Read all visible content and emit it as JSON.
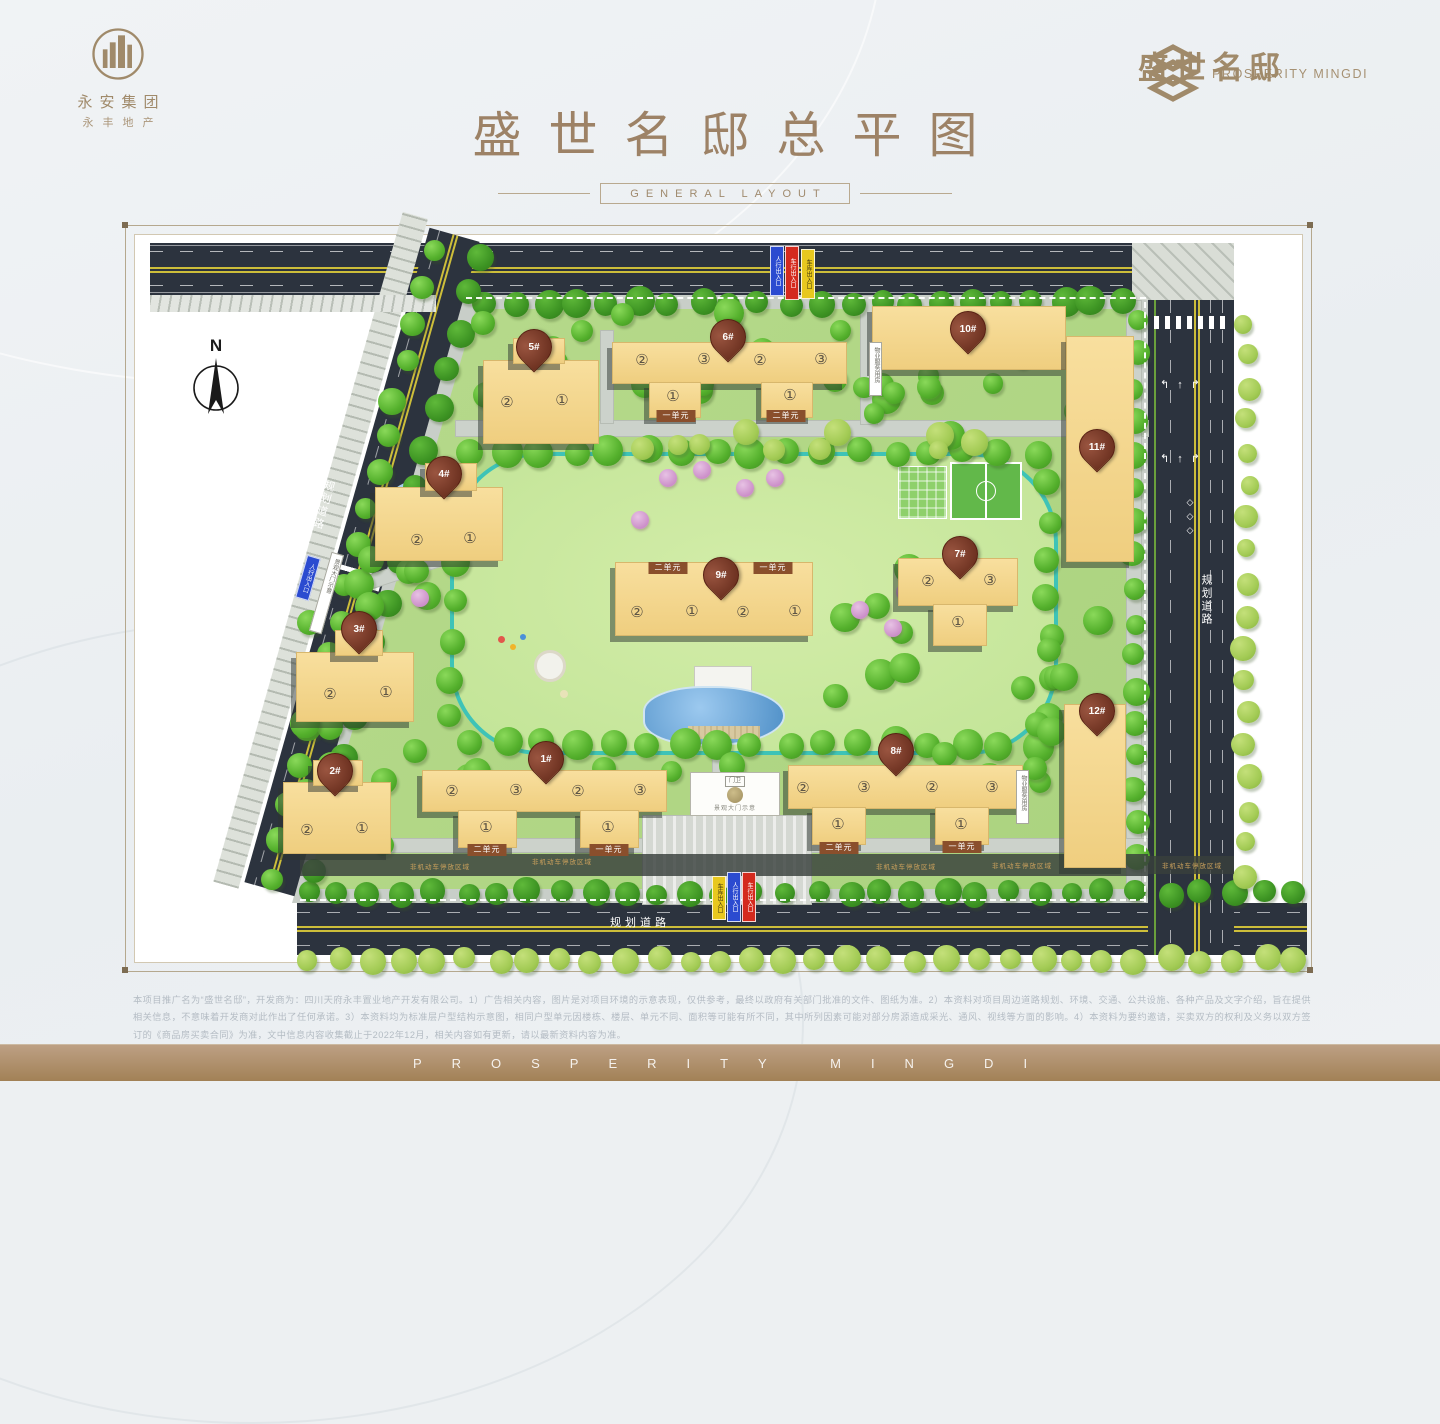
{
  "header": {
    "left_logo": {
      "line1": "永安集团",
      "line2": "永丰地产"
    },
    "title": "盛世名邸总平图",
    "subtitle": "GENERAL LAYOUT",
    "right_logo": {
      "cn": "盛世名邸",
      "en": "PROSPERITY MINGDI"
    }
  },
  "map": {
    "north_label": "N",
    "road_labels": [
      {
        "text": "规划道路",
        "x": 640,
        "y": 922,
        "mode": "h"
      },
      {
        "text": "规划道路",
        "x": 1206,
        "y": 600,
        "mode": "v"
      },
      {
        "text": "规划道路",
        "x": 323,
        "y": 505,
        "mode": "v",
        "rotate": 16
      }
    ],
    "entrance_flags": [
      {
        "text": "人行出入口",
        "color": "#2b4bd0",
        "x": 770,
        "y": 246,
        "h": 42
      },
      {
        "text": "车行出入口",
        "color": "#d42a1e",
        "x": 785,
        "y": 246,
        "h": 46
      },
      {
        "text": "车库出入口",
        "color": "#e8c81e",
        "x": 801,
        "y": 249,
        "h": 42,
        "dark": true
      },
      {
        "text": "车库出入口",
        "color": "#e8c81e",
        "x": 712,
        "y": 876,
        "h": 36,
        "dark": true
      },
      {
        "text": "人行出入口",
        "color": "#2b4bd0",
        "x": 727,
        "y": 872,
        "h": 42
      },
      {
        "text": "车行出入口",
        "color": "#d42a1e",
        "x": 742,
        "y": 872,
        "h": 42
      },
      {
        "text": "人行出入口",
        "color": "#2b4bd0",
        "x": 301,
        "y": 556,
        "h": 36,
        "rotate": 16
      }
    ],
    "signs": [
      {
        "text": "景观大门示意",
        "x": 320,
        "y": 552,
        "h": 80,
        "rotate": 16
      },
      {
        "text": "物业服务用房",
        "x": 869,
        "y": 342,
        "h": 52
      },
      {
        "text": "物业服务用房",
        "x": 1016,
        "y": 770,
        "h": 52
      }
    ],
    "gate_sign": {
      "text": "景观大门示意",
      "guard": "门卫",
      "x": 690,
      "y": 772,
      "w": 88,
      "h": 42
    },
    "parking_label": "非机动车停放区域",
    "parking_positions": [
      [
        440,
        866
      ],
      [
        562,
        861
      ],
      [
        906,
        866
      ],
      [
        1022,
        865
      ],
      [
        1192,
        865
      ]
    ],
    "buildings": [
      {
        "id": "1#",
        "pin": [
          545,
          782
        ],
        "rects": [
          [
            422,
            770,
            243,
            40
          ],
          [
            458,
            810,
            57,
            36
          ],
          [
            580,
            810,
            57,
            36
          ]
        ],
        "labels": [
          [
            "②",
            452,
            791
          ],
          [
            "③",
            516,
            790
          ],
          [
            "②",
            578,
            791
          ],
          [
            "③",
            640,
            790
          ],
          [
            "①",
            486,
            827
          ],
          [
            "①",
            608,
            827
          ]
        ],
        "banners": [
          [
            "二单元",
            487,
            850
          ],
          [
            "一单元",
            609,
            850
          ]
        ]
      },
      {
        "id": "2#",
        "pin": [
          334,
          794
        ],
        "rects": [
          [
            283,
            782,
            106,
            70
          ],
          [
            313,
            760,
            48,
            24
          ]
        ],
        "labels": [
          [
            "②",
            307,
            830
          ],
          [
            "①",
            362,
            828
          ]
        ],
        "banners": []
      },
      {
        "id": "3#",
        "pin": [
          358,
          652
        ],
        "rects": [
          [
            296,
            652,
            116,
            68
          ],
          [
            335,
            630,
            46,
            24
          ]
        ],
        "labels": [
          [
            "②",
            330,
            694
          ],
          [
            "①",
            386,
            692
          ]
        ],
        "banners": []
      },
      {
        "id": "4#",
        "pin": [
          443,
          497
        ],
        "rects": [
          [
            375,
            487,
            126,
            72
          ],
          [
            425,
            463,
            50,
            26
          ]
        ],
        "labels": [
          [
            "②",
            417,
            540
          ],
          [
            "①",
            470,
            538
          ]
        ],
        "banners": []
      },
      {
        "id": "5#",
        "pin": [
          533,
          370
        ],
        "rects": [
          [
            483,
            360,
            114,
            82
          ],
          [
            513,
            338,
            50,
            24
          ]
        ],
        "labels": [
          [
            "②",
            507,
            402
          ],
          [
            "①",
            562,
            400
          ]
        ],
        "banners": []
      },
      {
        "id": "6#",
        "pin": [
          727,
          360
        ],
        "rects": [
          [
            612,
            342,
            233,
            40
          ],
          [
            649,
            382,
            50,
            34
          ],
          [
            761,
            382,
            50,
            34
          ]
        ],
        "labels": [
          [
            "②",
            642,
            360
          ],
          [
            "③",
            704,
            359
          ],
          [
            "②",
            760,
            360
          ],
          [
            "③",
            821,
            359
          ],
          [
            "①",
            673,
            396
          ],
          [
            "①",
            790,
            395
          ]
        ],
        "banners": [
          [
            "一单元",
            676,
            416
          ],
          [
            "二单元",
            786,
            416
          ]
        ]
      },
      {
        "id": "7#",
        "pin": [
          959,
          577
        ],
        "rects": [
          [
            898,
            558,
            118,
            46
          ],
          [
            933,
            604,
            52,
            40
          ]
        ],
        "labels": [
          [
            "②",
            928,
            581
          ],
          [
            "③",
            990,
            580
          ],
          [
            "①",
            958,
            622
          ]
        ],
        "banners": []
      },
      {
        "id": "8#",
        "pin": [
          895,
          774
        ],
        "rects": [
          [
            788,
            765,
            233,
            42
          ],
          [
            812,
            807,
            52,
            36
          ],
          [
            935,
            807,
            52,
            36
          ]
        ],
        "labels": [
          [
            "②",
            803,
            788
          ],
          [
            "③",
            864,
            787
          ],
          [
            "②",
            932,
            787
          ],
          [
            "③",
            992,
            787
          ],
          [
            "①",
            838,
            824
          ],
          [
            "①",
            961,
            824
          ]
        ],
        "banners": [
          [
            "二单元",
            839,
            848
          ],
          [
            "一单元",
            962,
            847
          ]
        ]
      },
      {
        "id": "9#",
        "pin": [
          720,
          598
        ],
        "rects": [
          [
            615,
            562,
            196,
            72
          ]
        ],
        "labels": [
          [
            "②",
            637,
            612
          ],
          [
            "①",
            692,
            611
          ],
          [
            "②",
            743,
            612
          ],
          [
            "①",
            795,
            611
          ]
        ],
        "banners": [
          [
            "二单元",
            668,
            568
          ],
          [
            "一单元",
            773,
            568
          ]
        ]
      },
      {
        "id": "10#",
        "pin": [
          967,
          352
        ],
        "rects": [
          [
            872,
            306,
            192,
            62
          ]
        ],
        "labels": [],
        "banners": []
      },
      {
        "id": "11#",
        "pin": [
          1096,
          470
        ],
        "rects": [
          [
            1066,
            336,
            66,
            224
          ]
        ],
        "labels": [],
        "banners": []
      },
      {
        "id": "12#",
        "pin": [
          1096,
          734
        ],
        "rects": [
          [
            1064,
            704,
            60,
            162
          ]
        ],
        "labels": [],
        "banners": []
      }
    ],
    "colors": {
      "building": "#f5d892",
      "pin": "#7b3a27",
      "track": "#3ec3b7",
      "road": "#2c333e",
      "green": "#b7da8c",
      "accent": "#a08a6a"
    }
  },
  "footer": {
    "disclaimer": "本项目推广名为“盛世名邸”，开发商为：四川天府永丰置业地产开发有限公司。1）广告相关内容，图片是对项目环境的示意表现，仅供参考，最终以政府有关部门批准的文件、图纸为准。2）本资料对项目周边道路规划、环境、交通、公共设施、各种产品及文字介绍，旨在提供相关信息，不意味着开发商对此作出了任何承诺。3）本资料均为标准层户型结构示意图，相同户型单元因楼栋、楼层、单元不同、面积等可能有所不同，其中所列因素可能对部分房源造成采光、通风、视线等方面的影响。4）本资料为要约邀请，买卖双方的权利及义务以双方签订的《商品房买卖合同》为准，文中信息内容收集截止于2022年12月，相关内容如有更新，请以最新资料内容为准。",
    "bar_text": "PROSPERITY MINGDI"
  }
}
